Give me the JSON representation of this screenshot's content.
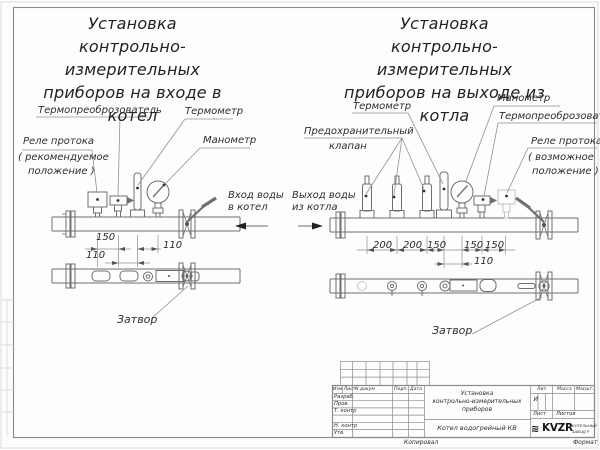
{
  "page": {
    "left": {
      "title": [
        "Установка",
        "контрольно-измерительных",
        "приборов на входе в",
        "котел"
      ],
      "labels": {
        "transducer": "Термопреоброзователь",
        "thermometer": "Термометр",
        "relay1": "Реле протока",
        "relay2": "( рекомендуемое",
        "relay3": "положение )",
        "manometer": "Манометр",
        "flow1": "Вход воды",
        "flow2": "в котел",
        "valve": "Затвор"
      },
      "dims": {
        "d150": "150",
        "d110a": "110",
        "d110b": "110"
      }
    },
    "right": {
      "title": [
        "Установка",
        "контрольно-измерительных",
        "приборов на выходе из",
        "котла"
      ],
      "labels": {
        "thermometer": "Термометр",
        "manometer": "Манометр",
        "transducer": "Термопреоброзователь",
        "safety1": "Предохранительный",
        "safety2": "клапан",
        "relay1": "Реле протока",
        "relay2": "( возможное",
        "relay3": "положение )",
        "flow1": "Выход воды",
        "flow2": "из котла",
        "valve": "Затвор"
      },
      "dims": {
        "d1": "200",
        "d2": "200",
        "d3": "150",
        "d4": "150",
        "d5": "150",
        "d6": "110"
      }
    },
    "stamp": {
      "h_izm": "Изм Лист",
      "h_doc": "N докум",
      "h_sign": "Подп.",
      "h_date": "Дата",
      "r1": "Разраб.",
      "r2": "Пров.",
      "r3": "Т. контр",
      "r4": "Н. контр",
      "r5": "Утв.",
      "title1": "Установка",
      "title2": "контрольно-измерительных",
      "title3": "приборов",
      "product": "Котел водогрейный КВ",
      "lit": "Лит.",
      "lit_v": "И",
      "mass": "Масса",
      "scale": "Масшт.",
      "sheet": "Лист",
      "sheets": "Листов",
      "logo_mark": "≋",
      "logo": "KVZR",
      "logo_t1": "КОТЕЛЬНЫЙ",
      "logo_t2": "ЗАВОД Р",
      "copied": "Копировал",
      "format": "Формат"
    }
  }
}
